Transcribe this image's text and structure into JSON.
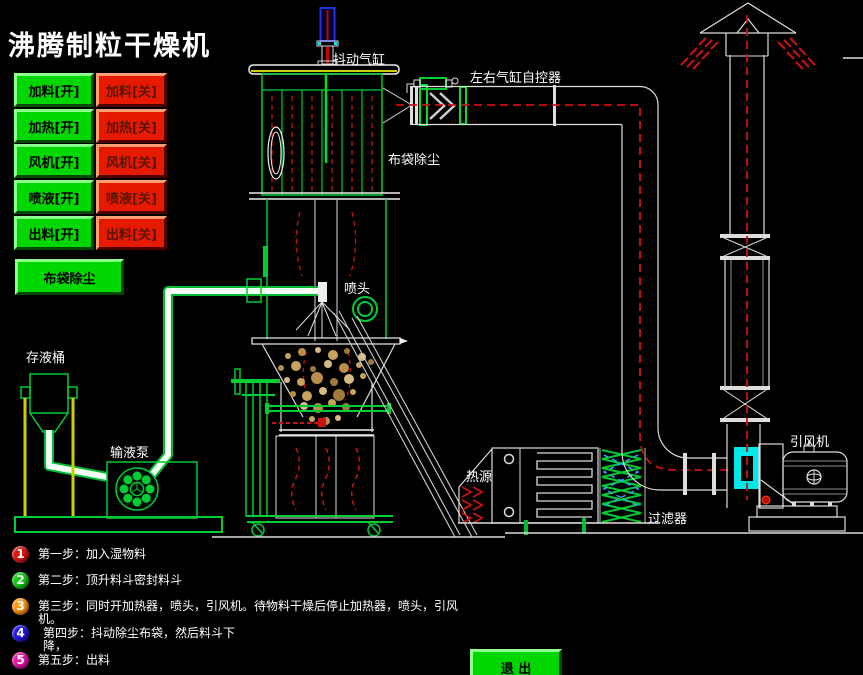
{
  "title": "沸腾制粒干燥机",
  "control_panel": {
    "pairs": [
      {
        "on": "加料[开]",
        "off": "加料[关]"
      },
      {
        "on": "加热[开]",
        "off": "加热[关]"
      },
      {
        "on": "风机[开]",
        "off": "风机[关]"
      },
      {
        "on": "喷液[开]",
        "off": "喷液[关]"
      },
      {
        "on": "出料[开]",
        "off": "出料[关]"
      }
    ],
    "bag_dust": "布袋除尘",
    "exit": "退 出"
  },
  "diagram_labels": {
    "shaker_cylinder": "抖动气缸",
    "lr_cylinder_controller": "左右气缸自控器",
    "bag_filter": "布袋除尘",
    "spray_head": "喷头",
    "liquid_tank": "存液桶",
    "liquid_pump": "输液泵",
    "heat_source": "热源",
    "filter": "过滤器",
    "induced_draft_fan": "引风机"
  },
  "steps": [
    {
      "num": "1",
      "color": "#dd1111",
      "text": "第一步：加入湿物料"
    },
    {
      "num": "2",
      "color": "#12cc12",
      "text": "第二步：顶升料斗密封料斗"
    },
    {
      "num": "3",
      "color": "#ff9911",
      "text": "第三步：同时开加热器，喷头，引风机。待物料干燥后停止加热器，喷头，引风机。"
    },
    {
      "num": "4",
      "color": "#2213ee",
      "text": "第四步：抖动除尘布袋，然后料斗下降，"
    },
    {
      "num": "5",
      "color": "#ee11aa",
      "text": "第五步：出料"
    }
  ],
  "colors": {
    "button_on_green": "#00d600",
    "button_off_red": "#e61a00",
    "structure_green": "#00cc33",
    "flow_red": "#cc1111",
    "damper_cyan": "#00e8e8",
    "support_yellow": "#cfcf00"
  }
}
